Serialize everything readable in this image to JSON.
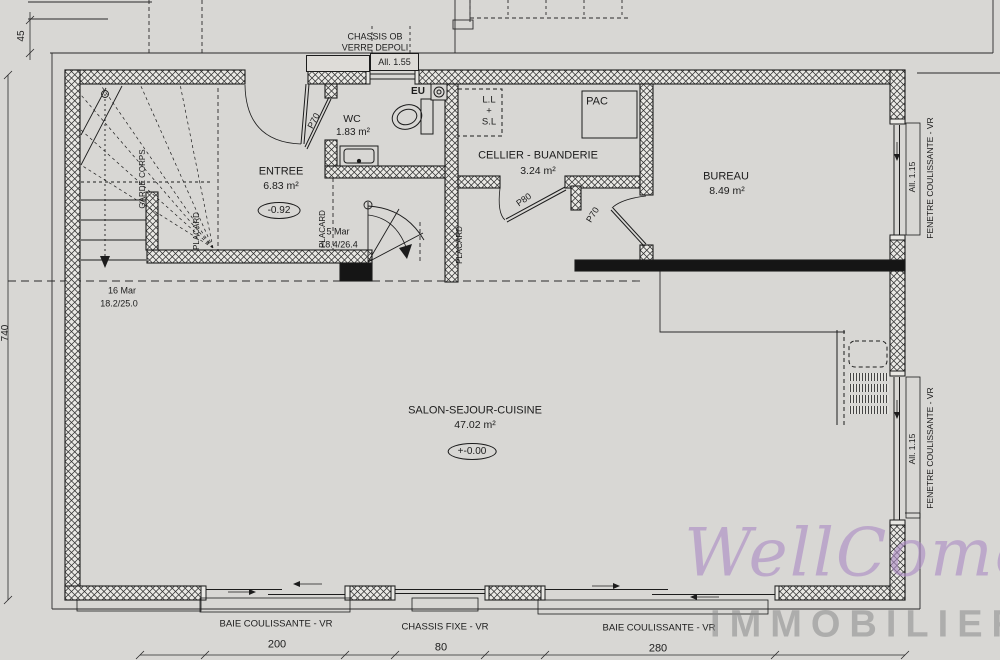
{
  "plan": {
    "rooms": {
      "entree": {
        "name": "ENTREE",
        "area": "6.83 m²",
        "level": "-0.92"
      },
      "wc": {
        "name": "WC",
        "area": "1.83 m²"
      },
      "cellier": {
        "name": "CELLIER - BUANDERIE",
        "area": "3.24 m²"
      },
      "bureau": {
        "name": "BUREAU",
        "area": "8.49 m²"
      },
      "salon": {
        "name": "SALON-SEJOUR-CUISINE",
        "area": "47.02 m²",
        "level": "+-0.00"
      }
    },
    "stairs": {
      "main": {
        "count": "16 Mar",
        "ratio": "18.2/25.0"
      },
      "winder": {
        "count": "5 Mar",
        "ratio": "18.4/26.4"
      }
    },
    "doors": {
      "p70": "P70",
      "p80": "P80"
    },
    "openings": {
      "chassis_ob_line1": "CHASSIS OB",
      "chassis_ob_line2": "VERRE DEPOLI",
      "allege_155": "All. 1.55",
      "allege_115": "All. 1.15",
      "fenetre_coulissante": "FENETRE COULISSANTE - VR",
      "baie_coulissante": "BAIE COULISSANTE - VR",
      "chassis_fixe": "CHASSIS FIXE - VR"
    },
    "features": {
      "garde_corps": "GARDE CORPS",
      "placard": "PLACARD",
      "eu": "EU",
      "pac": "PAC",
      "ll": "L.L",
      "plus": "+",
      "sl": "S.L"
    },
    "dimensions": {
      "d45": "45",
      "d740": "740",
      "d200": "200",
      "d80": "80",
      "d280": "280"
    }
  },
  "watermark": {
    "brand": "WellCome",
    "subtitle": "IMMOBILIER",
    "brand_color": "#ab8ac4",
    "subtitle_color": "#8a8a8a"
  },
  "colors": {
    "paper": "#d8d7d4",
    "ink": "#1c1c1c"
  }
}
